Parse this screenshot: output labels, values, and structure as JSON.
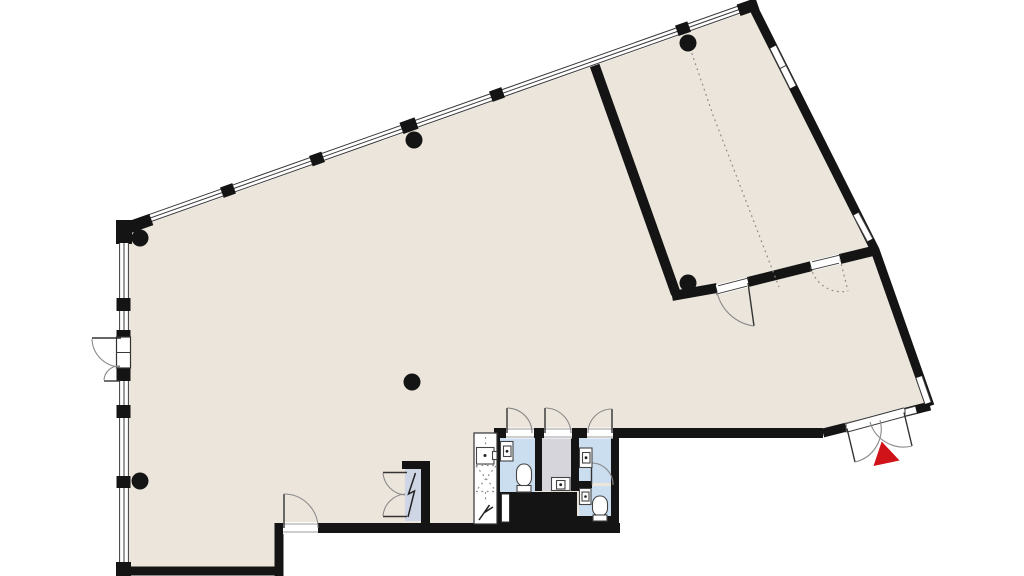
{
  "colors": {
    "bg": "#ffffff",
    "floor": "#ece5db",
    "wall": "#141414",
    "window_line": "#3a3a3a",
    "door_line": "#8a8a8a",
    "dash": "#8a8a8a",
    "wet_floor": "#cbdef0",
    "service_floor": "#d7d5dc",
    "closet_floor": "#ced5e4",
    "marker_red": "#cf1318"
  },
  "plan": {
    "type": "floor-plan",
    "rooms": [
      {
        "name": "main-hall",
        "floor_color_ref": "floor"
      },
      {
        "name": "side-room",
        "floor_color_ref": "floor"
      },
      {
        "name": "wc-cell-1",
        "floor_color_ref": "wet_floor"
      },
      {
        "name": "service-cell",
        "floor_color_ref": "service_floor"
      },
      {
        "name": "wc-cell-2",
        "floor_color_ref": "wet_floor"
      },
      {
        "name": "wc-cell-3",
        "floor_color_ref": "wet_floor"
      },
      {
        "name": "shaft",
        "floor_color_ref": "bg"
      },
      {
        "name": "electrical-closet",
        "floor_color_ref": "closet_floor"
      }
    ],
    "columns": {
      "count": 6
    },
    "fixtures": {
      "toilets": 2,
      "washbasins": 4,
      "utility_sink": 1,
      "lightning_symbols": 2
    },
    "doors": {
      "exterior_double": 2,
      "interior_single": 7,
      "interior_double": 1,
      "dashed_opening": 1
    },
    "windows": {
      "window_wall_sides": [
        "north-west",
        "west",
        "east"
      ]
    },
    "entrance_marker": {
      "shape": "triangle",
      "color_ref": "marker_red"
    }
  }
}
